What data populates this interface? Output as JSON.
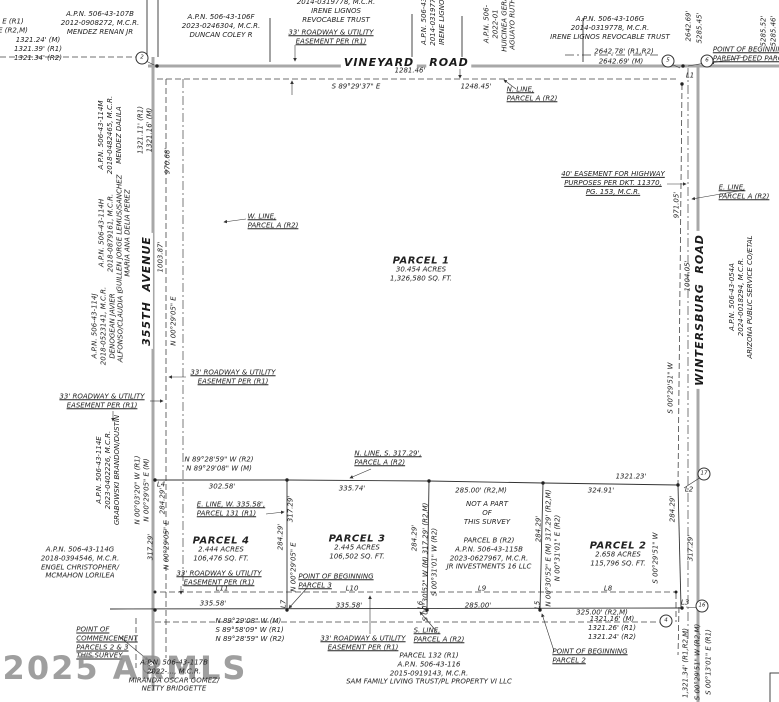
{
  "document_type": "land survey plat",
  "colors": {
    "background": "#ffffff",
    "road": "#a8a8a8",
    "line": "#333333",
    "watermark": "#8f8f8f"
  },
  "roads": {
    "north": "VINEYARD ROAD",
    "west": "355TH AVENUE",
    "east": "WINTERSBURG ROAD"
  },
  "labels": [
    {
      "n": "apn-mendez-renan",
      "t": "A.P.N. 506-43-107B\n2012-0908272, M.C.R.\nMENDEZ RENAN JR",
      "x": 100,
      "y": 23
    },
    {
      "n": "apn-duncan-coley",
      "t": "A.P.N. 506-43-106F\n2023-0246304, M.C.R.\nDUNCAN COLEY R",
      "x": 221,
      "y": 26
    },
    {
      "n": "apn-irene-partial",
      "t": "2014-0319778, M.C.R.\nIRENE LIGNOS\nREVOCABLE TRUST",
      "x": 336,
      "y": 11
    },
    {
      "n": "easement-top-north",
      "t": "33' ROADWAY & UTILITY\nEASEMENT PER (R1)",
      "x": 331,
      "y": 37,
      "cls": "ul"
    },
    {
      "n": "apn-irene-rot",
      "t": "A.P.N. 506-43-\n2014-0319778\nIRENE LIGNOS",
      "x": 433,
      "y": 20,
      "rot": true
    },
    {
      "n": "apn-aguayo-rot",
      "t": "A.P.N. 506-\n2022-01\nHUICINEA GERA\nAGUAYO RUTH",
      "x": 500,
      "y": 24,
      "rot": true
    },
    {
      "n": "apn-irene-trust",
      "t": "A.P.N. 506-43-106G\n2014-0319778, M.C.R.\nIRENE LIGNOS REVOCABLE TRUST",
      "x": 610,
      "y": 28
    },
    {
      "n": "dim-2642-record",
      "t": "2642.78' (R1,R2)",
      "x": 624,
      "y": 52
    },
    {
      "n": "dim-2642-measured",
      "t": "2642.69' (M)",
      "x": 621,
      "y": 62
    },
    {
      "n": "vineyard-name",
      "t": "VINEYARD",
      "x": 379,
      "y": 63,
      "cls": "road"
    },
    {
      "n": "vineyard-road-word",
      "t": "ROAD",
      "x": 449,
      "y": 63,
      "cls": "road"
    },
    {
      "n": "bearing-vineyard",
      "t": "S 89°29'37\" E",
      "x": 356,
      "y": 87
    },
    {
      "n": "dim-1281",
      "t": "1281.46'",
      "x": 410,
      "y": 71
    },
    {
      "n": "dim-1248",
      "t": "1248.45'",
      "x": 476,
      "y": 87
    },
    {
      "n": "n-line-parcel-a",
      "t": "N. LINE,\nPARCEL A (R2)",
      "x": 532,
      "y": 94,
      "cls": "ul tl"
    },
    {
      "n": "pob-parent-deed",
      "t": "POINT OF BEGINNING\nPARENT DEED PARCEL",
      "x": 752,
      "y": 54,
      "cls": "ul tl"
    },
    {
      "n": "dim-2642-vert",
      "t": "2642.69'",
      "x": 689,
      "y": 26,
      "rot": true
    },
    {
      "n": "dim-5285-vert",
      "t": "5285.45'",
      "x": 700,
      "y": 28,
      "rot": true
    },
    {
      "n": "dim-5285-right-1",
      "t": "5285.52'",
      "x": 764,
      "y": 31,
      "rot": true
    },
    {
      "n": "dim-5285-right-2",
      "t": "5285.46'",
      "x": 774,
      "y": 31,
      "rot": true
    },
    {
      "n": "line-label-l1",
      "t": "L1",
      "x": 690,
      "y": 76
    },
    {
      "n": "corner-circle-5",
      "t": "5",
      "x": 668,
      "y": 61,
      "cls": "circ"
    },
    {
      "n": "corner-circle-6",
      "t": "6",
      "x": 707,
      "y": 61,
      "cls": "circ"
    },
    {
      "n": "corner-circle-2",
      "t": "2",
      "x": 142,
      "y": 58,
      "cls": "circ"
    },
    {
      "n": "highway-easement",
      "t": "40' EASEMENT FOR HIGHWAY\nPURPOSES PER DKT. 11370,\nPG. 153, M.C.R.",
      "x": 613,
      "y": 183,
      "cls": "ul"
    },
    {
      "n": "e-line-parcel-a",
      "t": "E. LINE,\nPARCEL A (R2)",
      "x": 744,
      "y": 192,
      "cls": "ul tl"
    },
    {
      "n": "dim-971",
      "t": "971.05'",
      "x": 677,
      "y": 205,
      "rot": true
    },
    {
      "n": "wintersburg-name",
      "t": "WINTERSBURG  ROAD",
      "x": 700,
      "y": 310,
      "cls": "road",
      "rot": true
    },
    {
      "n": "dim-1004",
      "t": "1004.05'",
      "x": 688,
      "y": 276,
      "rot": true
    },
    {
      "n": "apn-aps",
      "t": "A.P.N. 506-43-054A\n2024-0018294, M.C.R.\nARIZONA PUBLIC SERVICE CO/ETAL",
      "x": 741,
      "y": 297,
      "rot": true
    },
    {
      "n": "bearing-e-line",
      "t": "S 00°29'51\" W",
      "x": 671,
      "y": 388,
      "rot": true
    },
    {
      "n": "partial-bearing-left",
      "t": "E (R1)\nE (R2,M)",
      "x": 13,
      "y": 26
    },
    {
      "n": "dim-1321-topleft",
      "t": "1321.24' (M)\n1321.39' (R1)\n1321.34' (R2)",
      "x": 38,
      "y": 49
    },
    {
      "n": "apn-mendez-dalila",
      "t": "A.P.N. 506-43-114M\n2018-0482465, M.C.R.\nMENDEZ DALILA",
      "x": 110,
      "y": 135,
      "rot": true
    },
    {
      "n": "dim-1321-ave",
      "t": "1321.11' (R1)\n1321.16' (M)",
      "x": 145,
      "y": 130,
      "rot": true
    },
    {
      "n": "dim-970",
      "t": "970.68'",
      "x": 168,
      "y": 161,
      "rot": true
    },
    {
      "n": "apn-guillen",
      "t": "A.P.N. 506-43-114H\n2018-0879161, M.C.R.\nGUILLEN JORGE LEMUS/SANCHEZ\nMARIA ANA DELIA PEREZ",
      "x": 115,
      "y": 233,
      "rot": true
    },
    {
      "n": "avenue-355-name",
      "t": "355TH  AVENUE",
      "x": 147,
      "y": 291,
      "cls": "road",
      "rot": true
    },
    {
      "n": "dim-1003",
      "t": "1003.87'",
      "x": 161,
      "y": 257,
      "rot": true
    },
    {
      "n": "apn-denogean",
      "t": "A.P.N. 506-43-114J\n2018-0523141, M.C.R.\nDENOGEAN JAVIER\nALFONSO/CLAUDIA L",
      "x": 108,
      "y": 326,
      "rot": true
    },
    {
      "n": "w-line-parcel-a",
      "t": "W. LINE,\nPARCEL A (R2)",
      "x": 273,
      "y": 221,
      "cls": "ul tl"
    },
    {
      "n": "bearing-w-line",
      "t": "N 00°29'05\" E",
      "x": 174,
      "y": 321,
      "rot": true
    },
    {
      "n": "easement-west-in",
      "t": "33' ROADWAY & UTILITY\nEASEMENT PER (R1)",
      "x": 233,
      "y": 377,
      "cls": "ul"
    },
    {
      "n": "easement-west-out",
      "t": "33' ROADWAY & UTILITY\nEASEMENT PER (R1)",
      "x": 102,
      "y": 401,
      "cls": "ul"
    },
    {
      "n": "apn-grabowski",
      "t": "A.P.N. 506-43-114E\n2023-0402226, M.C.R.\nGRABOWSKI BRANDON/DUSTIN",
      "x": 108,
      "y": 470,
      "rot": true
    },
    {
      "n": "bearing-l4",
      "t": "N 00°03'20\" W (R1)\nN 00°29'05\" E (M)",
      "x": 142,
      "y": 490,
      "rot": true
    },
    {
      "n": "line-label-l4",
      "t": "L4",
      "x": 161,
      "y": 485
    },
    {
      "n": "dim-284-ave",
      "t": "284.29'",
      "x": 163,
      "y": 501,
      "rot": true
    },
    {
      "n": "dim-317-ave",
      "t": "317.29'",
      "x": 151,
      "y": 547,
      "rot": true
    },
    {
      "n": "bearing-ave-south",
      "t": "N 00°29'05\" E",
      "x": 167,
      "y": 545,
      "rot": true
    },
    {
      "n": "apn-engel",
      "t": "A.P.N. 506-43-114G\n2018-0394546, M.C.R.\nENGEL CHRISTOPHER/\nMCMAHON LORILEA",
      "x": 80,
      "y": 563
    },
    {
      "n": "corner-circle-8",
      "t": "8",
      "x": 149,
      "y": 667,
      "cls": "circ"
    },
    {
      "n": "point-of-commencement",
      "t": "POINT OF\nCOMMENCEMENT\nPARCELS 2 & 3\nTHIS SURVEY",
      "x": 107,
      "y": 643,
      "cls": "ul tl"
    },
    {
      "n": "armls-watermark",
      "t": "2025 ARMLS",
      "x": 125,
      "y": 668,
      "cls": "wm"
    },
    {
      "n": "apn-miranda",
      "t": "A.P.N. 506-43-117B\n2022-…, M.C.R.\nMIRANDA OSCAR GOMEZ/\nNETTY BRIDGETTE",
      "x": 174,
      "y": 676
    },
    {
      "n": "bearing-mid-west",
      "t": "N 89°28'59\" W (R2)\nN 89°29'08\" W (M)",
      "x": 219,
      "y": 464
    },
    {
      "n": "dim-302",
      "t": "302.58'",
      "x": 222,
      "y": 487
    },
    {
      "n": "n-line-s317",
      "t": "N. LINE, S. 317.29',\nPARCEL A (R2)",
      "x": 388,
      "y": 458,
      "cls": "ul tl"
    },
    {
      "n": "dim-335-74",
      "t": "335.74'",
      "x": 352,
      "y": 489
    },
    {
      "n": "dim-285-mid",
      "t": "285.00' (R2,M)",
      "x": 481,
      "y": 491
    },
    {
      "n": "dim-324-91",
      "t": "324.91'",
      "x": 601,
      "y": 491
    },
    {
      "n": "dim-1321-23",
      "t": "1321.23'",
      "x": 631,
      "y": 477
    },
    {
      "n": "line-label-l2",
      "t": "L2",
      "x": 689,
      "y": 490
    },
    {
      "n": "corner-circle-17",
      "t": "17",
      "x": 704,
      "y": 474,
      "cls": "circ"
    },
    {
      "n": "e-line-w335",
      "t": "E. LINE, W. 335.58',\nPARCEL 131 (R1)",
      "x": 231,
      "y": 509,
      "cls": "ul tl"
    },
    {
      "n": "parcel1-title",
      "t": "PARCEL 1",
      "x": 421,
      "y": 261,
      "cls": "pt"
    },
    {
      "n": "parcel1-sub",
      "t": "30.454 ACRES\n1,326,580 SQ. FT.",
      "x": 421,
      "y": 274
    },
    {
      "n": "parcel4-title",
      "t": "PARCEL 4",
      "x": 221,
      "y": 541,
      "cls": "pt"
    },
    {
      "n": "parcel4-sub",
      "t": "2.444 ACRES\n106,476 SQ. FT.",
      "x": 221,
      "y": 554
    },
    {
      "n": "parcel3-title",
      "t": "PARCEL 3",
      "x": 357,
      "y": 539,
      "cls": "pt"
    },
    {
      "n": "parcel3-sub",
      "t": "2.445 ACRES\n106,502 SQ. FT.",
      "x": 357,
      "y": 552
    },
    {
      "n": "parcel2-title",
      "t": "PARCEL 2",
      "x": 618,
      "y": 546,
      "cls": "pt"
    },
    {
      "n": "parcel2-sub",
      "t": "2.658 ACRES\n115,796 SQ. FT.",
      "x": 618,
      "y": 559
    },
    {
      "n": "not-a-part",
      "t": "NOT A PART\nOF\nTHIS SURVEY",
      "x": 487,
      "y": 513
    },
    {
      "n": "parcel-b-apn",
      "t": "PARCEL B (R2)\nA.P.N. 506-43-115B\n2023-0627967, M.C.R.\nJR INVESTMENTS 16 LLC",
      "x": 489,
      "y": 554
    },
    {
      "n": "dim-317-l7",
      "t": "317.29'",
      "x": 291,
      "y": 509,
      "rot": true
    },
    {
      "n": "dim-284-l7",
      "t": "284.29'",
      "x": 281,
      "y": 537,
      "rot": true
    },
    {
      "n": "bearing-l7",
      "t": "N 00°29'05\" E",
      "x": 294,
      "y": 567,
      "rot": true
    },
    {
      "n": "dim-284-l6",
      "t": "284.29'",
      "x": 415,
      "y": 538,
      "rot": true
    },
    {
      "n": "bearing-l6",
      "t": "S 00°30'52\" W (M) 317.29' (R2,M)\nS 00°31'01\" W (R2)",
      "x": 430,
      "y": 562,
      "rot": true
    },
    {
      "n": "dim-284-l5",
      "t": "284.29'",
      "x": 539,
      "y": 529,
      "rot": true
    },
    {
      "n": "bearing-l5",
      "t": "N 00°30'52\" E (M) 317.29' (R2,M)\nN 00°31'01\" E (R2)",
      "x": 553,
      "y": 548,
      "rot": true
    },
    {
      "n": "dim-284-east",
      "t": "284.29'",
      "x": 673,
      "y": 509,
      "rot": true
    },
    {
      "n": "bearing-parcel2-east",
      "t": "S 00°29'51\" W",
      "x": 656,
      "y": 558,
      "rot": true
    },
    {
      "n": "dim-317-east",
      "t": "317.29'",
      "x": 691,
      "y": 548,
      "rot": true
    },
    {
      "n": "easement-parcel4",
      "t": "33' ROADWAY & UTILITY\nEASEMENT PER (R1)",
      "x": 219,
      "y": 578,
      "cls": "ul"
    },
    {
      "n": "line-label-l11",
      "t": "L11",
      "x": 222,
      "y": 589
    },
    {
      "n": "dim-335-58-a",
      "t": "335.58'",
      "x": 213,
      "y": 604
    },
    {
      "n": "pob-parcel3",
      "t": "POINT OF BEGINNING\nPARCEL 3",
      "x": 336,
      "y": 581,
      "cls": "ul tl"
    },
    {
      "n": "line-label-l10",
      "t": "L10",
      "x": 352,
      "y": 589
    },
    {
      "n": "dim-335-58-b",
      "t": "335.58'",
      "x": 349,
      "y": 606
    },
    {
      "n": "line-label-l7",
      "t": "L7",
      "x": 284,
      "y": 604,
      "rot": true
    },
    {
      "n": "line-label-l6",
      "t": "L6",
      "x": 421,
      "y": 605,
      "rot": true
    },
    {
      "n": "line-label-l5",
      "t": "L5",
      "x": 538,
      "y": 605,
      "rot": true
    },
    {
      "n": "bearing-south-line",
      "t": "N 89°29'08\" W (M)\nS 89°58'09\" W (R1)\nN 89°28'59\" W (R2)",
      "x": 250,
      "y": 630,
      "cls": "tl"
    },
    {
      "n": "easement-south",
      "t": "33' ROADWAY & UTILITY\nEASEMENT PER (R1)",
      "x": 363,
      "y": 643,
      "cls": "ul"
    },
    {
      "n": "s-line-parcel-a",
      "t": "S. LINE,\nPARCEL A (R2)",
      "x": 439,
      "y": 635,
      "cls": "ul tl"
    },
    {
      "n": "line-label-l9",
      "t": "L9",
      "x": 482,
      "y": 589
    },
    {
      "n": "dim-285-bottom",
      "t": "285.00'",
      "x": 478,
      "y": 606
    },
    {
      "n": "line-label-l8",
      "t": "L8",
      "x": 608,
      "y": 589
    },
    {
      "n": "dim-325",
      "t": "325.00' (R2,M)",
      "x": 602,
      "y": 613
    },
    {
      "n": "line-label-l3",
      "t": "L3",
      "x": 685,
      "y": 603
    },
    {
      "n": "corner-circle-16",
      "t": "16",
      "x": 702,
      "y": 606,
      "cls": "circ"
    },
    {
      "n": "dim-1321-bottomright",
      "t": "1321.16' (M)\n1321.26' (R1)\n1321.24' (R2)",
      "x": 612,
      "y": 628
    },
    {
      "n": "corner-circle-4",
      "t": "4",
      "x": 666,
      "y": 621,
      "cls": "circ"
    },
    {
      "n": "pob-parcel2",
      "t": "POINT OF BEGINNING\nPARCEL 2",
      "x": 590,
      "y": 656,
      "cls": "ul tl"
    },
    {
      "n": "sam-family-parcel",
      "t": "PARCEL 132 (R1)\nA.P.N. 506-43-116\n2015-0919143, M.C.R.\nSAM FAMILY LIVING TRUST/PL PROPERTY VI LLC",
      "x": 429,
      "y": 669
    },
    {
      "n": "dim-1321-34-rot",
      "t": "1,321.34' (R1,R2,M)",
      "x": 686,
      "y": 663,
      "rot": true
    },
    {
      "n": "bearing-bottomright-1",
      "t": "S 00°29'51\" W (R2,M)",
      "x": 698,
      "y": 662,
      "rot": true
    },
    {
      "n": "bearing-bottomright-2",
      "t": "S 00°13'01\" E (R1)",
      "x": 709,
      "y": 662,
      "rot": true
    }
  ]
}
